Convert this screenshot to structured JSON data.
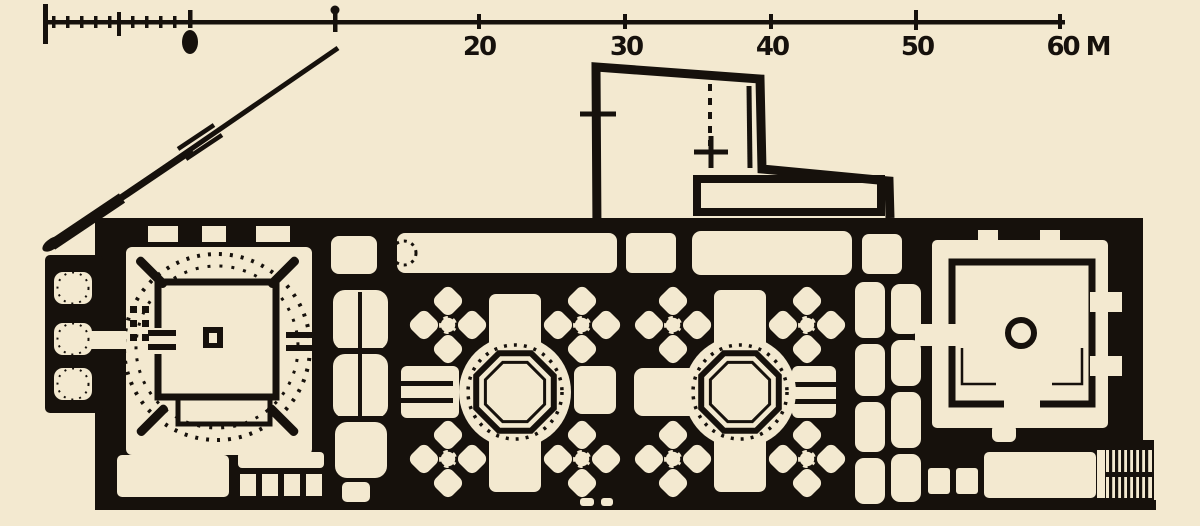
{
  "meta": {
    "description": "Scanned black-and-white architectural ground plan of an elongated multi-domed building (mosque/kulliye plan) with a metric scale bar and a north arrow",
    "drawing_type": "floor-plan",
    "units": "M"
  },
  "colors": {
    "paper": "#f3e9d0",
    "ink": "#16110c"
  },
  "scale_bar": {
    "unit_suffix": "M",
    "labels": [
      {
        "text": "20"
      },
      {
        "text": "30"
      },
      {
        "text": "40"
      },
      {
        "text": "50"
      },
      {
        "text": "60 M"
      }
    ]
  },
  "plan": {
    "parts": [
      "scale-bar",
      "north-arrow",
      "upper-annex-outline",
      "left-domed-hall-with-courtyard",
      "west-cells",
      "central-octagonal-hall-1",
      "central-octagonal-hall-2",
      "right-domed-hall",
      "staircase"
    ]
  }
}
